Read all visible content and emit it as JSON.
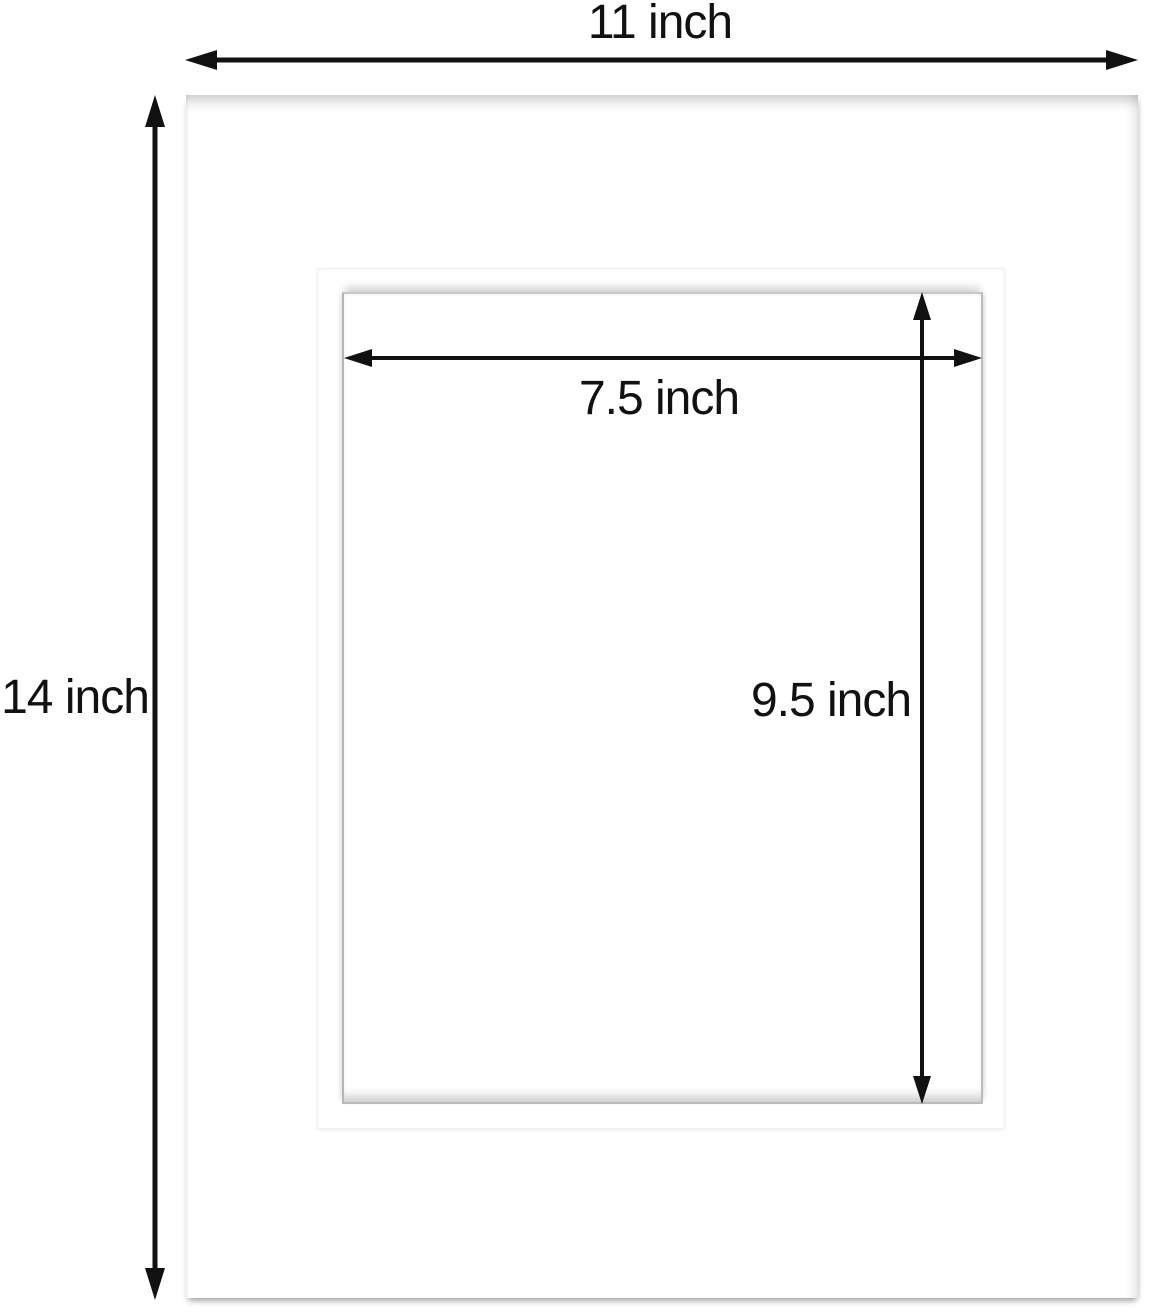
{
  "diagram": {
    "type": "product-dimension-diagram",
    "subject": "white picture-frame mat board with rectangular beveled opening",
    "outer": {
      "width_label": "11 inch",
      "height_label": "14 inch"
    },
    "opening": {
      "width_label": "7.5 inch",
      "height_label": "9.5 inch"
    },
    "colors": {
      "background": "#ffffff",
      "mat": "#ffffff",
      "arrow": "#111111",
      "text": "#111111",
      "edge_shadow": "#c9c9c9"
    }
  }
}
